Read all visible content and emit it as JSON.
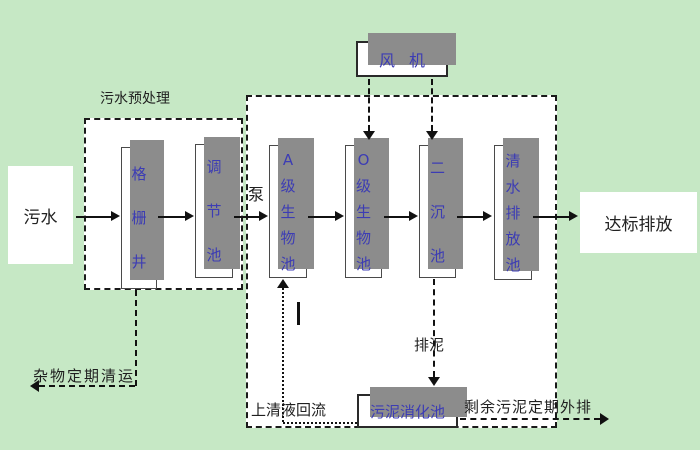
{
  "diagram_title": "A/O wastewater treatment process flow",
  "colors": {
    "background": "#c6e8c5",
    "box_fill": "#ffffff",
    "box_shadow": "#8c8c8c",
    "box_text": "#3c3cb4",
    "label_text": "#1f1f1f",
    "line": "#111111"
  },
  "labels": {
    "influent": "污水",
    "pretreatment_title": "污水预处理",
    "pump": "泵",
    "discharge": "达标排放",
    "debris_removal": "杂物定期清运",
    "supernatant_return": "上清液回流",
    "sludge_discharge": "排泥",
    "excess_sludge_out": "剩余污泥定期外排"
  },
  "blower": {
    "label": "风机"
  },
  "tanks": [
    {
      "id": "grid-well",
      "label": "格栅井"
    },
    {
      "id": "regulating-tank",
      "label": "调节池"
    },
    {
      "id": "a-bio-tank",
      "label": "A级生物池"
    },
    {
      "id": "o-bio-tank",
      "label": "O级生物池"
    },
    {
      "id": "secondary-sedimentation-tank",
      "label": "二沉池"
    },
    {
      "id": "clean-water-discharge-tank",
      "label": "清水排放池"
    }
  ],
  "sludge_digestion_tank": {
    "label": "污泥消化池"
  },
  "edges": [
    {
      "from": "污水",
      "to": "格栅井",
      "style": "solid-arrow"
    },
    {
      "from": "格栅井",
      "to": "调节池",
      "style": "solid-arrow"
    },
    {
      "from": "调节池",
      "to": "A级生物池",
      "style": "solid-arrow",
      "via": "泵"
    },
    {
      "from": "A级生物池",
      "to": "O级生物池",
      "style": "solid-arrow"
    },
    {
      "from": "O级生物池",
      "to": "二沉池",
      "style": "solid-arrow"
    },
    {
      "from": "二沉池",
      "to": "清水排放池",
      "style": "solid-arrow"
    },
    {
      "from": "清水排放池",
      "to": "达标排放",
      "style": "solid-arrow"
    },
    {
      "from": "风机",
      "to": "O级生物池",
      "style": "dashed-arrow-down"
    },
    {
      "from": "风机",
      "to": "二沉池",
      "style": "dashed-arrow-down"
    },
    {
      "from": "二沉池",
      "to": "污泥消化池",
      "style": "dashed-arrow-down",
      "label": "排泥"
    },
    {
      "from": "污泥消化池",
      "to": "A级生物池",
      "style": "dotted-arrow-up",
      "label": "上清液回流"
    },
    {
      "from": "污泥消化池",
      "to": "外排",
      "style": "dashed-arrow-right",
      "label": "剩余污泥定期外排"
    },
    {
      "from": "格栅井",
      "to": "外运",
      "style": "dashed-arrow-left",
      "label": "杂物定期清运"
    }
  ]
}
